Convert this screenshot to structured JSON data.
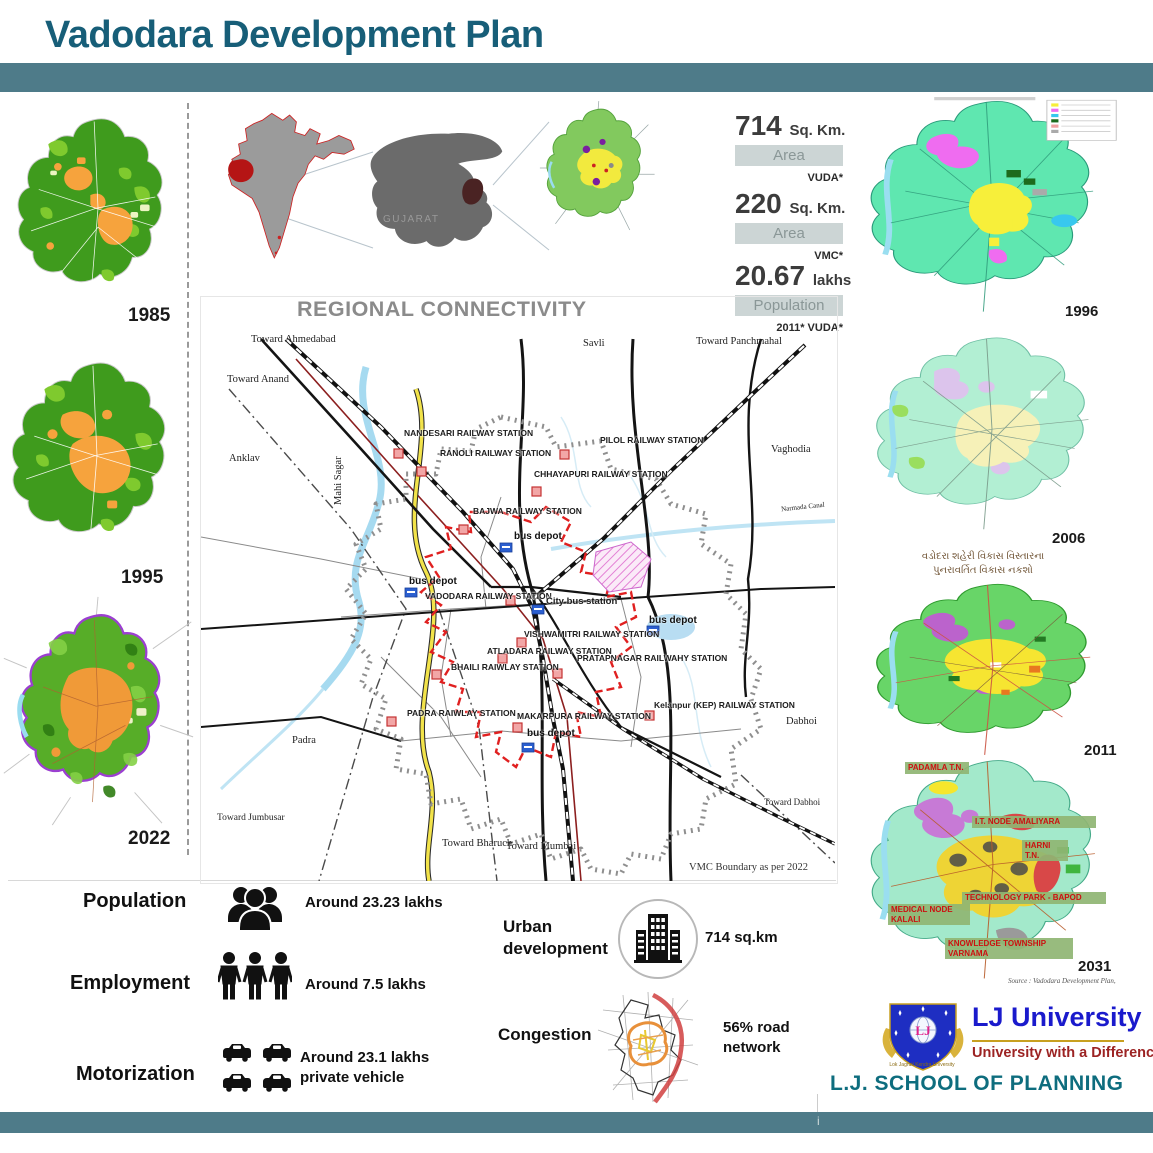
{
  "colors": {
    "accent_teal": "#4e7b89",
    "title_teal": "#175e78",
    "school_teal": "#0e6d7e",
    "lj_blue": "#1a1acc",
    "lj_red": "#9c2323",
    "stat_box_bg": "#ccd5d5"
  },
  "header": {
    "title": "Vadodara Development Plan"
  },
  "left_timeline": {
    "years": [
      "1985",
      "1995",
      "2022"
    ]
  },
  "locator": {
    "gujarat": "GUJARAT"
  },
  "stats": [
    {
      "value": "714",
      "unit": "Sq. Km.",
      "box": "Area",
      "source": "VUDA*"
    },
    {
      "value": "220",
      "unit": "Sq. Km.",
      "box": "Area",
      "source": "VMC*"
    },
    {
      "value": "20.67",
      "unit": "lakhs",
      "box": "Population",
      "source": "2011* VUDA*"
    }
  ],
  "regional": {
    "title": "REGIONAL CONNECTIVITY",
    "note": "VMC Boundary as per 2022",
    "depot": "bus depot",
    "stations": {
      "nandesari": "NANDESARI RAILWAY STATION",
      "ranoli": "RANOLI RAILWAY STATION",
      "pilol": "PILOL RAILWAY STATION",
      "chhayapuri": "CHHAYAPURI RAILWAY STATION",
      "bajwa": "BAJWA RAILWAY STATION",
      "vadodara": "VADODARA RAILWAY STATION",
      "city_bus": "City bus station",
      "vishwamitri": "VISHWAMITRI RAILWAY STATION",
      "atladara": "ATLADARA RAILWAY STATION",
      "pratapnagar": "PRATAPNAGAR RAILWAHY STATION",
      "bhaili": "BHAILI RAIWLAY STATION",
      "padra": "PADRA RAIWLAY STATION",
      "makarpura": "MAKARPURA RAILWAY STATION",
      "kelanpur": "Kelanpur (KEP) RAILWAY STATION"
    },
    "places": {
      "ahmedabad": "Toward Ahmedabad",
      "anand": "Toward Anand",
      "anklav": "Anklav",
      "mahisagar": "Mahi Sagar",
      "savli": "Savli",
      "panchmahal": "Toward Panchmahal",
      "vaghodia": "Vaghodia",
      "narmada": "Narmada Canal",
      "padra_town": "Padra",
      "jumbusar": "Toward Jumbusar",
      "bharuch": "Toward Bharuch",
      "mumbai": "Toward Mumbai",
      "toward_dabhoi": "Toward Dabhoi",
      "dabhoi": "Dabhoi"
    }
  },
  "right_maps": {
    "years": [
      "1996",
      "2006",
      "2011",
      "2031"
    ],
    "caption_2011_line1": "વડોદરા શહેરી વિકાસ વિસ્તારના",
    "caption_2011_line2": "પુનરાવર્તિત વિકાસ નકશો",
    "plan_labels": [
      "PADAMLA T.N.",
      "I.T. NODE AMALIYARA",
      "HARNI T.N.",
      "TECHNOLOGY PARK - BAPOD",
      "MEDICAL NODE KALALI",
      "KNOWLEDGE TOWNSHIP VARNAMA"
    ],
    "source": "Source : Vadodara Development Plan,"
  },
  "indicators": [
    {
      "label": "Population",
      "value": "Around 23.23 lakhs"
    },
    {
      "label": "Employment",
      "value": "Around 7.5 lakhs"
    },
    {
      "label": "Motorization",
      "value": "Around 23.1 lakhs private vehicle"
    }
  ],
  "urban_development": {
    "label": "Urban development",
    "value": "714 sq.km"
  },
  "congestion": {
    "label": "Congestion",
    "value": "56% road network"
  },
  "footer": {
    "shield_initials": "LJ",
    "ribbon": "Lok Jagruti Kendra University",
    "university": "LJ University",
    "tagline": "University with a Difference",
    "school": "L.J. SCHOOL OF PLANNING",
    "page_marker": "i"
  }
}
